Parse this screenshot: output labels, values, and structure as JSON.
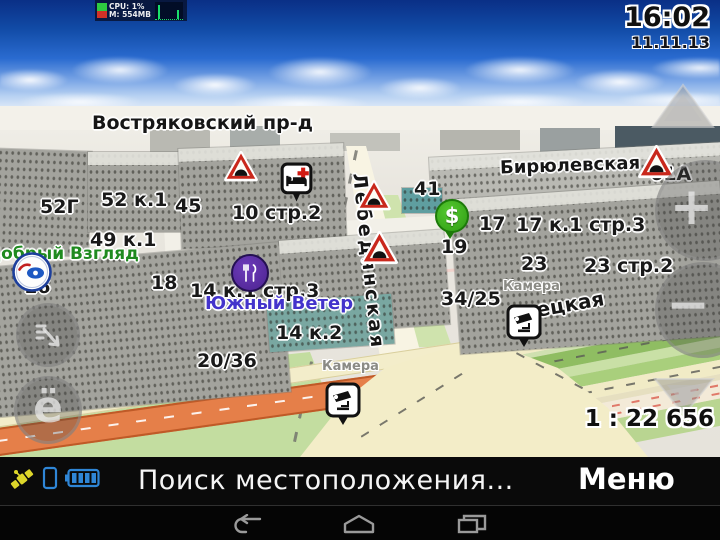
{
  "system_monitor": {
    "cpu": "CPU: 1%",
    "memory": "M: 554MB"
  },
  "clock": {
    "time": "16:02",
    "date": "11.11.13"
  },
  "map": {
    "scale_label": "1 : 22 656",
    "streets": {
      "vostryakovskiy": "Востряковский пр-д",
      "biryulevskaya": "Бирюлевская",
      "lebedyanskaya": "Лебедянская",
      "lipetskaya_partial": "ецкая"
    },
    "poi_names": {
      "optician": "Добрый Взгляд",
      "restaurant": "Южный Ветер"
    },
    "camera_label_1": "Камера",
    "camera_label_2": "Камера",
    "house_numbers": {
      "h52g": "52Г",
      "h52k1": "52 к.1",
      "h45": "45",
      "h49k1": "49 к.1",
      "h10s2": "10 стр.2",
      "h16": "16",
      "h18": "18",
      "h14k1s3": "14 к.1 стр.3",
      "h14k2": "14 к.2",
      "h20_36": "20/36",
      "h41": "41",
      "h17": "17",
      "h19": "19",
      "h17k1s3": "17 к.1 стр.3",
      "h23": "23",
      "h23s2": "23 стр.2",
      "h34_25": "34/25",
      "h61a": "61А"
    },
    "controls": {
      "zoom_in": "+",
      "zoom_out": "−",
      "yo_button": "ё"
    },
    "atm_glyph": "$"
  },
  "bottom_bar": {
    "status_text": "Поиск местоположения...",
    "menu_label": "Меню"
  },
  "colors": {
    "warning_red": "#c9281c",
    "atm_green": "#39b01e",
    "restaurant_purple": "#5b2da0",
    "poi_text_green": "#1f8a1f",
    "poi_text_blue": "#4333cb",
    "highway_orange": "#e57f49",
    "road_yellow": "#f1ebc6",
    "grass_green": "#c3dda0",
    "status_blue": "#2f86d6",
    "satellite_yellow": "#ddd62a"
  }
}
